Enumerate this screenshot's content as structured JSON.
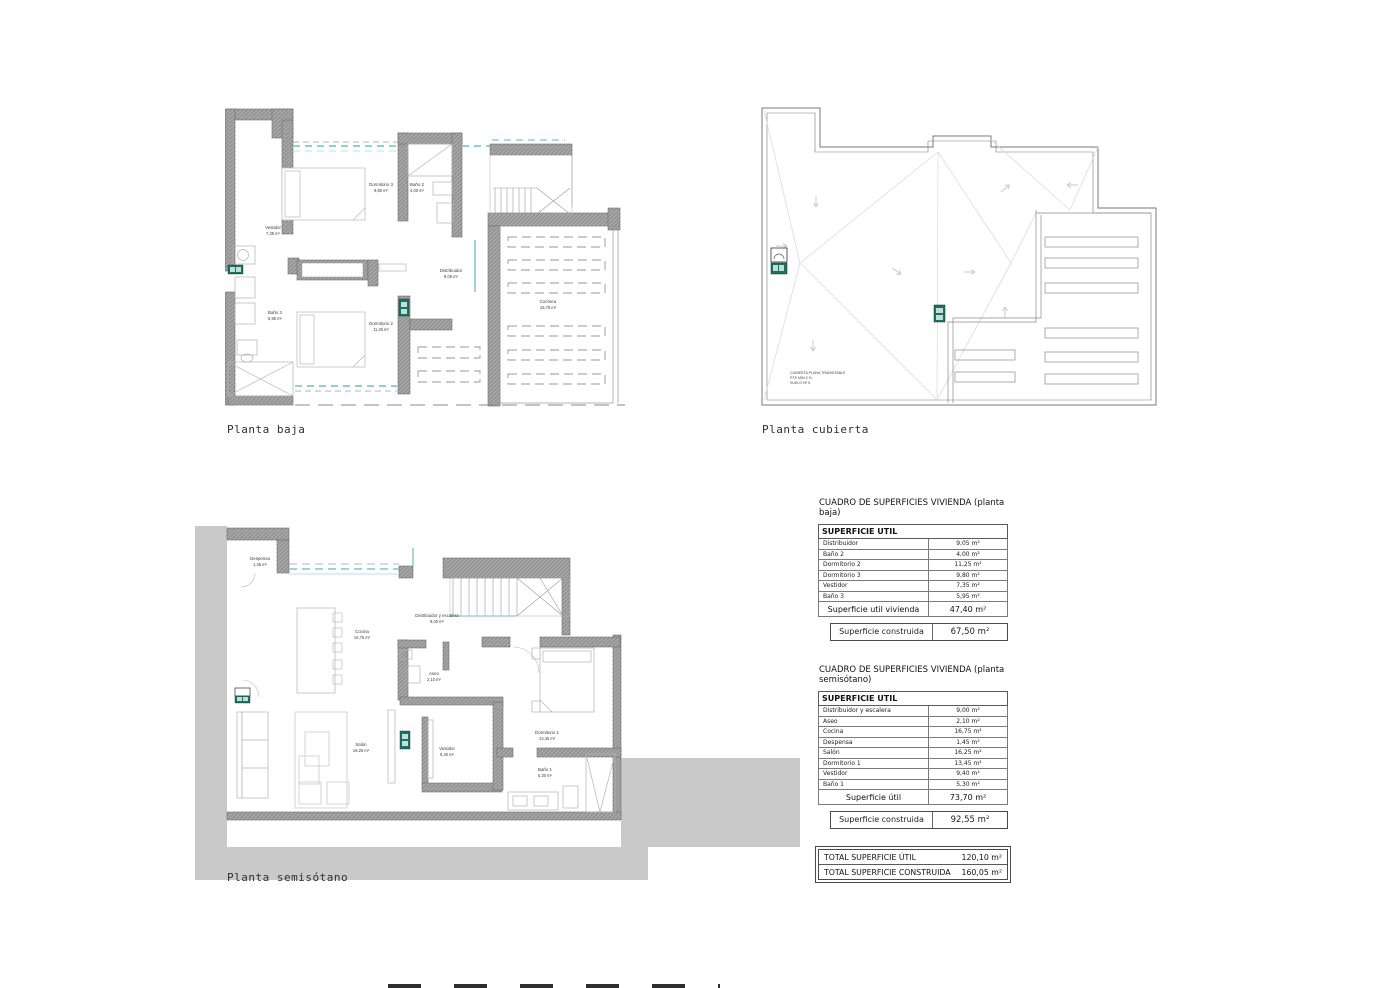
{
  "plans": [
    {
      "id": "planta-baja",
      "title": "Planta baja",
      "rooms": [
        {
          "name": "Dormitorio 3",
          "area": "9,80 m²"
        },
        {
          "name": "Baño 2",
          "area": "4,00 m²"
        },
        {
          "name": "Vestidor",
          "area": "7,35 m²"
        },
        {
          "name": "Baño 3",
          "area": "5,95 m²"
        },
        {
          "name": "Dormitorio 2",
          "area": "11,25 m²"
        },
        {
          "name": "Distribuidor",
          "area": "9,05 m²"
        },
        {
          "name": "Cochera",
          "area": "16,75 m²"
        }
      ]
    },
    {
      "id": "planta-cubierta",
      "title": "Planta cubierta",
      "annotation": {
        "line1": "CUBIERTA PLANA TRANSITABLE",
        "line2": "PTE MIN 2 %",
        "line3": "SUELO Nº 5"
      }
    },
    {
      "id": "planta-semisotano",
      "title": "Planta semisótano",
      "rooms": [
        {
          "name": "Despensa",
          "area": "1,45 m²"
        },
        {
          "name": "Distribuidor y escalera",
          "area": "9,00 m²"
        },
        {
          "name": "Cocina",
          "area": "16,75 m²"
        },
        {
          "name": "Aseo",
          "area": "2,10 m²"
        },
        {
          "name": "Salón",
          "area": "16,25 m²"
        },
        {
          "name": "Vestidor",
          "area": "9,40 m²"
        },
        {
          "name": "Dormitorio 1",
          "area": "13,45 m²"
        },
        {
          "name": "Baño 1",
          "area": "5,30 m²"
        }
      ]
    }
  ],
  "tables": [
    {
      "title": "CUADRO DE SUPERFICIES VIVIENDA (planta baja)",
      "header": "SUPERFICIE  UTIL",
      "rows": [
        [
          "Distribuidor",
          "9,05 m²"
        ],
        [
          "Baño 2",
          "4,00 m²"
        ],
        [
          "Dormitorio 2",
          "11,25 m²"
        ],
        [
          "Dormitorio 3",
          "9,80 m²"
        ],
        [
          "Vestidor",
          "7,35 m²"
        ],
        [
          "Baño 3",
          "5,95 m²"
        ]
      ],
      "total_label": "Superficie util vivienda",
      "total_value": "47,40 m²",
      "construida_label": "Superficie construida",
      "construida_value": "67,50 m²"
    },
    {
      "title": "CUADRO DE SUPERFICIES VIVIENDA (planta semisótano)",
      "header": "SUPERFICIE  UTIL",
      "rows": [
        [
          "Distribuidor y escalera",
          "9,00 m²"
        ],
        [
          "Aseo",
          "2,10 m²"
        ],
        [
          "Cocina",
          "16,75 m²"
        ],
        [
          "Despensa",
          "1,45 m²"
        ],
        [
          "Salón",
          "16,25 m²"
        ],
        [
          "Dormitorio 1",
          "13,45 m²"
        ],
        [
          "Vestidor",
          "9,40 m²"
        ],
        [
          "Baño 1",
          "5,30 m²"
        ]
      ],
      "total_label": "Superficie útil",
      "total_value": "73,70 m²",
      "construida_label": "Superficie construida",
      "construida_value": "92,55 m²"
    }
  ],
  "totals": {
    "rows": [
      [
        "TOTAL SUPERFICIE  ÚTIL",
        "120,10 m²"
      ],
      [
        "TOTAL SUPERFICIE  CONSTRUIDA",
        "160,05 m²"
      ]
    ]
  },
  "colors": {
    "wall": "#9d9d9d",
    "earth_fill": "#c9c9c9",
    "accent_teal": "#8ecfd4",
    "marker_green": "#1f6f63",
    "drawing_line": "#8a8a8a"
  }
}
